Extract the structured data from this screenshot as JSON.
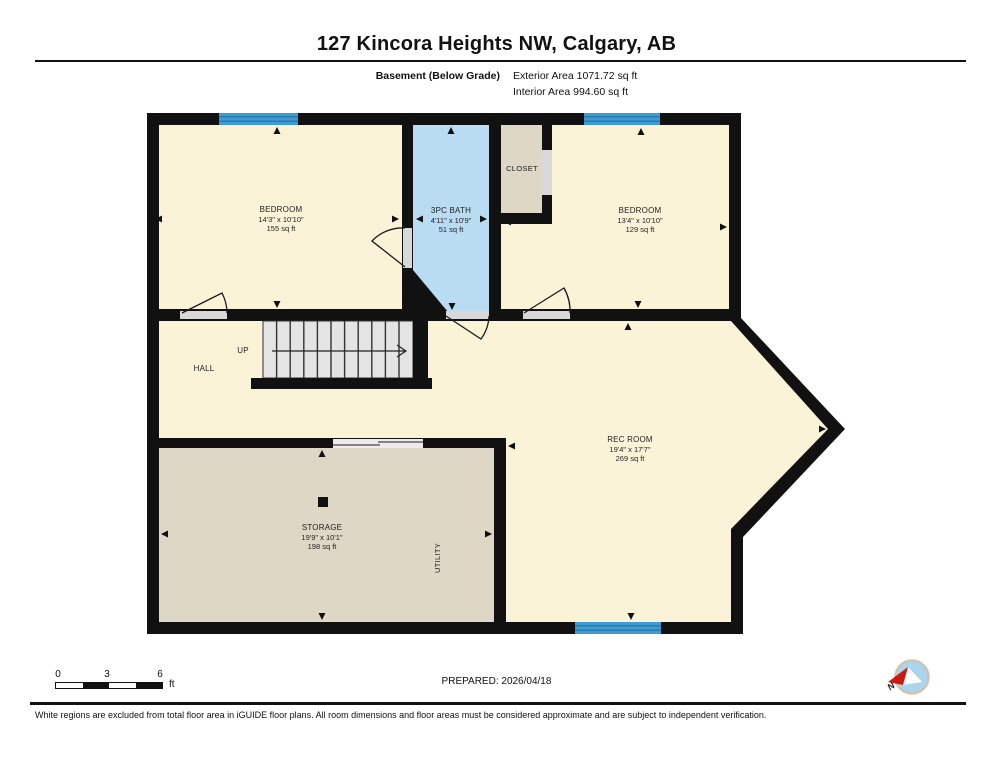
{
  "header": {
    "title": "127 Kincora Heights NW, Calgary, AB",
    "floor_label": "Basement (Below Grade)",
    "exterior_area": "Exterior Area 1071.72 sq ft",
    "interior_area": "Interior Area 994.60 sq ft"
  },
  "plan": {
    "rooms": {
      "bedroom1": {
        "name": "BEDROOM",
        "dims": "14'3\" x 10'10\"",
        "area": "155 sq ft"
      },
      "bath": {
        "name": "3PC BATH",
        "dims": "4'11\" x 10'9\"",
        "area": "51 sq ft"
      },
      "closet": {
        "name": "CLOSET"
      },
      "bedroom2": {
        "name": "BEDROOM",
        "dims": "13'4\" x 10'10\"",
        "area": "129 sq ft"
      },
      "hall": {
        "name": "HALL"
      },
      "stairs": {
        "direction": "UP"
      },
      "rec_room": {
        "name": "REC ROOM",
        "dims": "19'4\" x 17'7\"",
        "area": "269 sq ft"
      },
      "storage": {
        "name": "STORAGE",
        "dims": "19'9\" x 10'1\"",
        "area": "198 sq ft"
      },
      "utility": {
        "name": "UTILITY"
      }
    },
    "colors": {
      "wall": "#111111",
      "floor": "#fbf3d8",
      "bath_floor": "#b9dcf2",
      "storage_floor": "#ded7c5",
      "window": "#3f9bd3",
      "opening": "#d8d8d8",
      "stairs": "#e4e4e4",
      "compass_red": "#cc1a10",
      "compass_blue": "#aad5ec"
    }
  },
  "scale_bar": {
    "tick0": "0",
    "tick1": "3",
    "tick2": "6",
    "unit": "ft"
  },
  "prepared_label": "PREPARED: 2026/04/18",
  "compass": {
    "north_label": "N"
  },
  "disclaimer": "White regions are excluded from total floor area in iGUIDE floor plans. All room dimensions and floor areas must be considered approximate and are subject to independent verification."
}
